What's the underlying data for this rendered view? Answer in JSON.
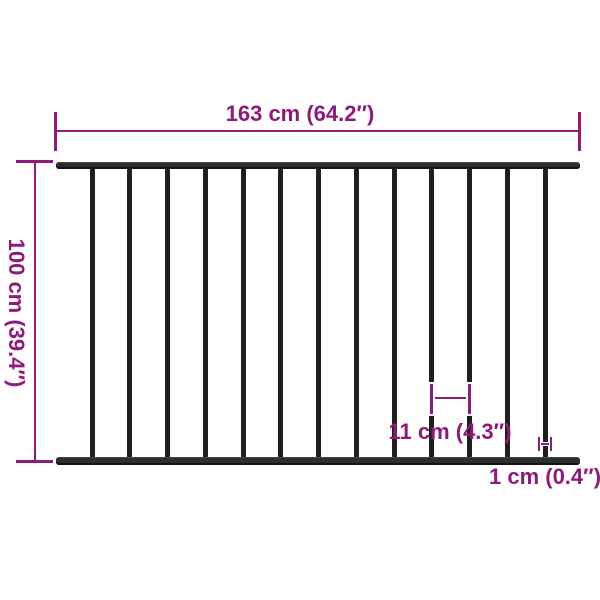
{
  "colors": {
    "accent": "#8e1b7b",
    "fence": "#1f1f1f",
    "rail": "#2d2d2d",
    "background": "#ffffff"
  },
  "fence": {
    "description": "steel fence panel front view",
    "bar_count": 13,
    "rail_count": 2
  },
  "dimensions": {
    "width_label": "163 cm (64.2″)",
    "height_label": "100 cm (39.4″)",
    "gap_label": "11 cm (4.3″)",
    "bar_thickness_label": "1 cm (0.4″)"
  }
}
